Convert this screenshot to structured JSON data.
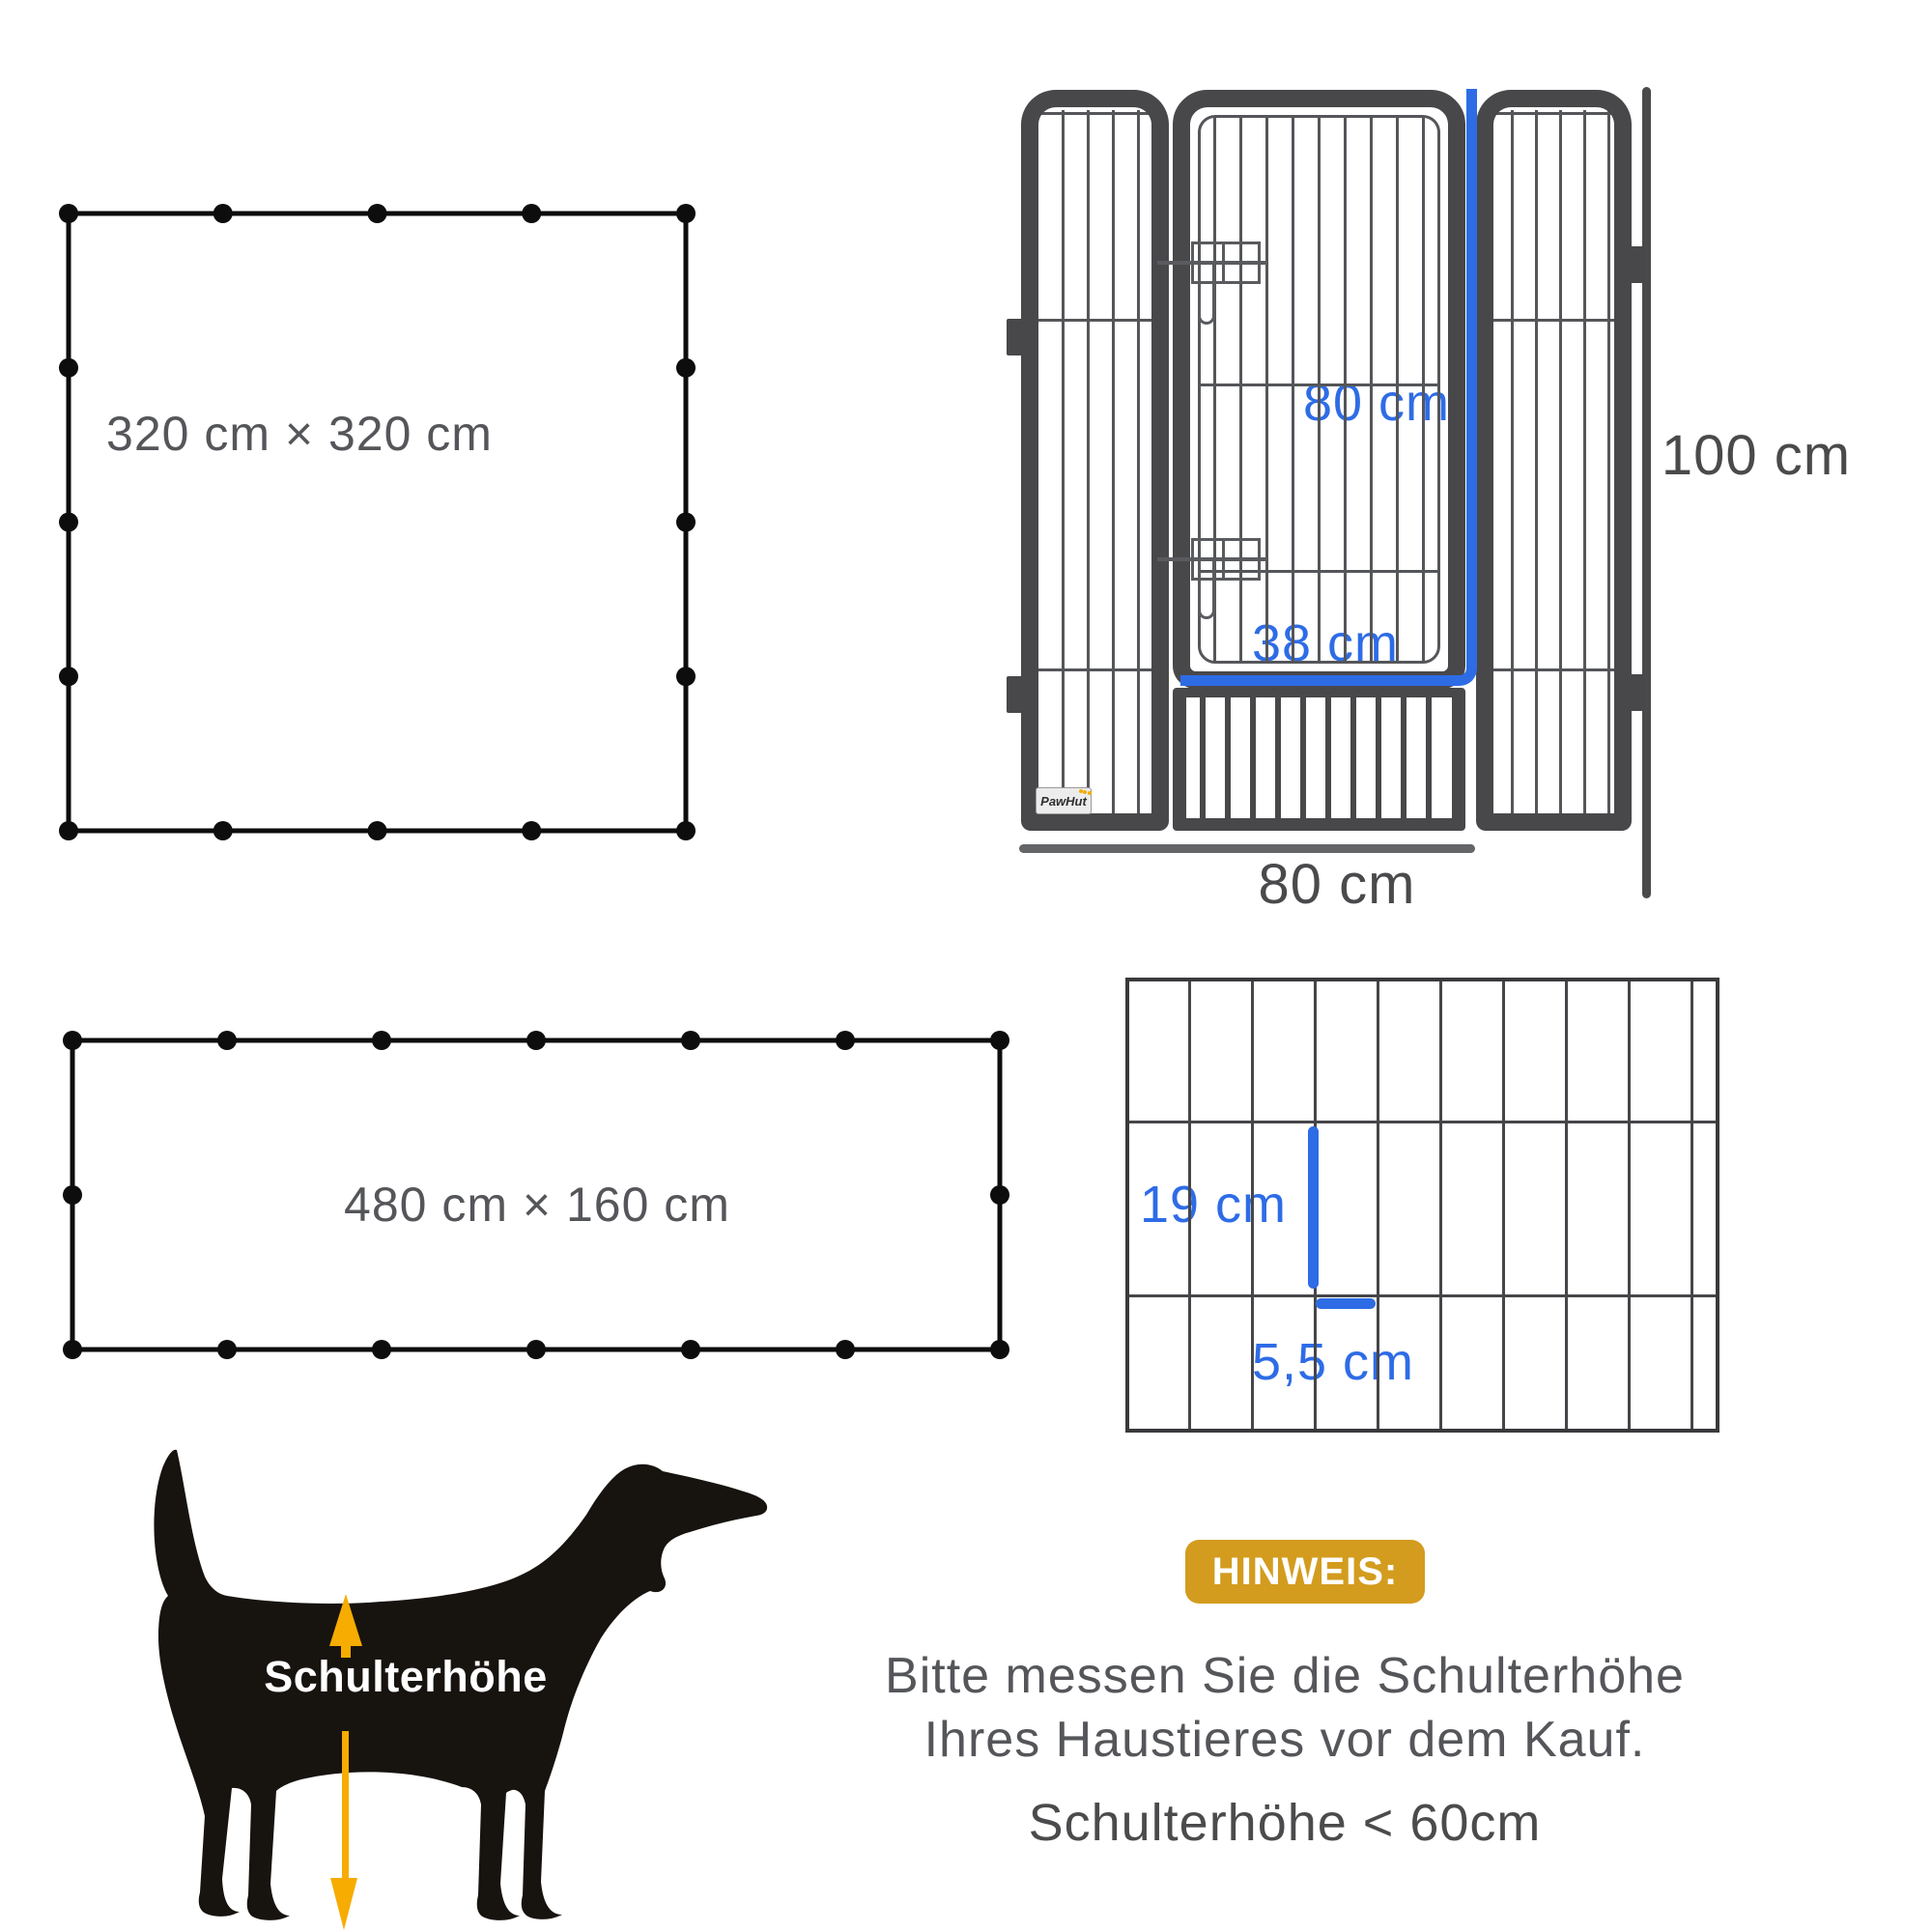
{
  "page": {
    "background": "#ffffff"
  },
  "colors": {
    "blue": "#2E6CE6",
    "amber": "#F6AC00",
    "badge_gold": "#D39C1E",
    "frame_charcoal": "#48484B",
    "wire_gray": "#55565A",
    "text_gray": "#55565A",
    "text_dark": "#4A4A4C",
    "dog_black": "#17130F",
    "line_black": "#0D0D0D"
  },
  "layouts": {
    "square": {
      "label": "320 cm × 320 cm",
      "panels_per_side": 4,
      "panel_length_cm": 80
    },
    "rectangle": {
      "label": "480 cm × 160 cm",
      "panels_wide": 6,
      "panels_high": 2,
      "panel_length_cm": 80
    }
  },
  "panel_diagram": {
    "door_height_label": "80 cm",
    "door_width_label": "38 cm",
    "total_height_label": "100 cm",
    "panel_width_label": "80 cm",
    "brand_label": "PawHut"
  },
  "mesh_diagram": {
    "bar_spacing_height_label": "19 cm",
    "bar_spacing_width_label": "5,5 cm"
  },
  "dog_diagram": {
    "shoulder_height_label": "Schulterhöhe"
  },
  "note": {
    "badge_label": "HINWEIS:",
    "line1": "Bitte messen Sie die Schulterhöhe",
    "line2": "Ihres Haustieres vor dem Kauf.",
    "line3": "Schulterhöhe < 60cm"
  }
}
